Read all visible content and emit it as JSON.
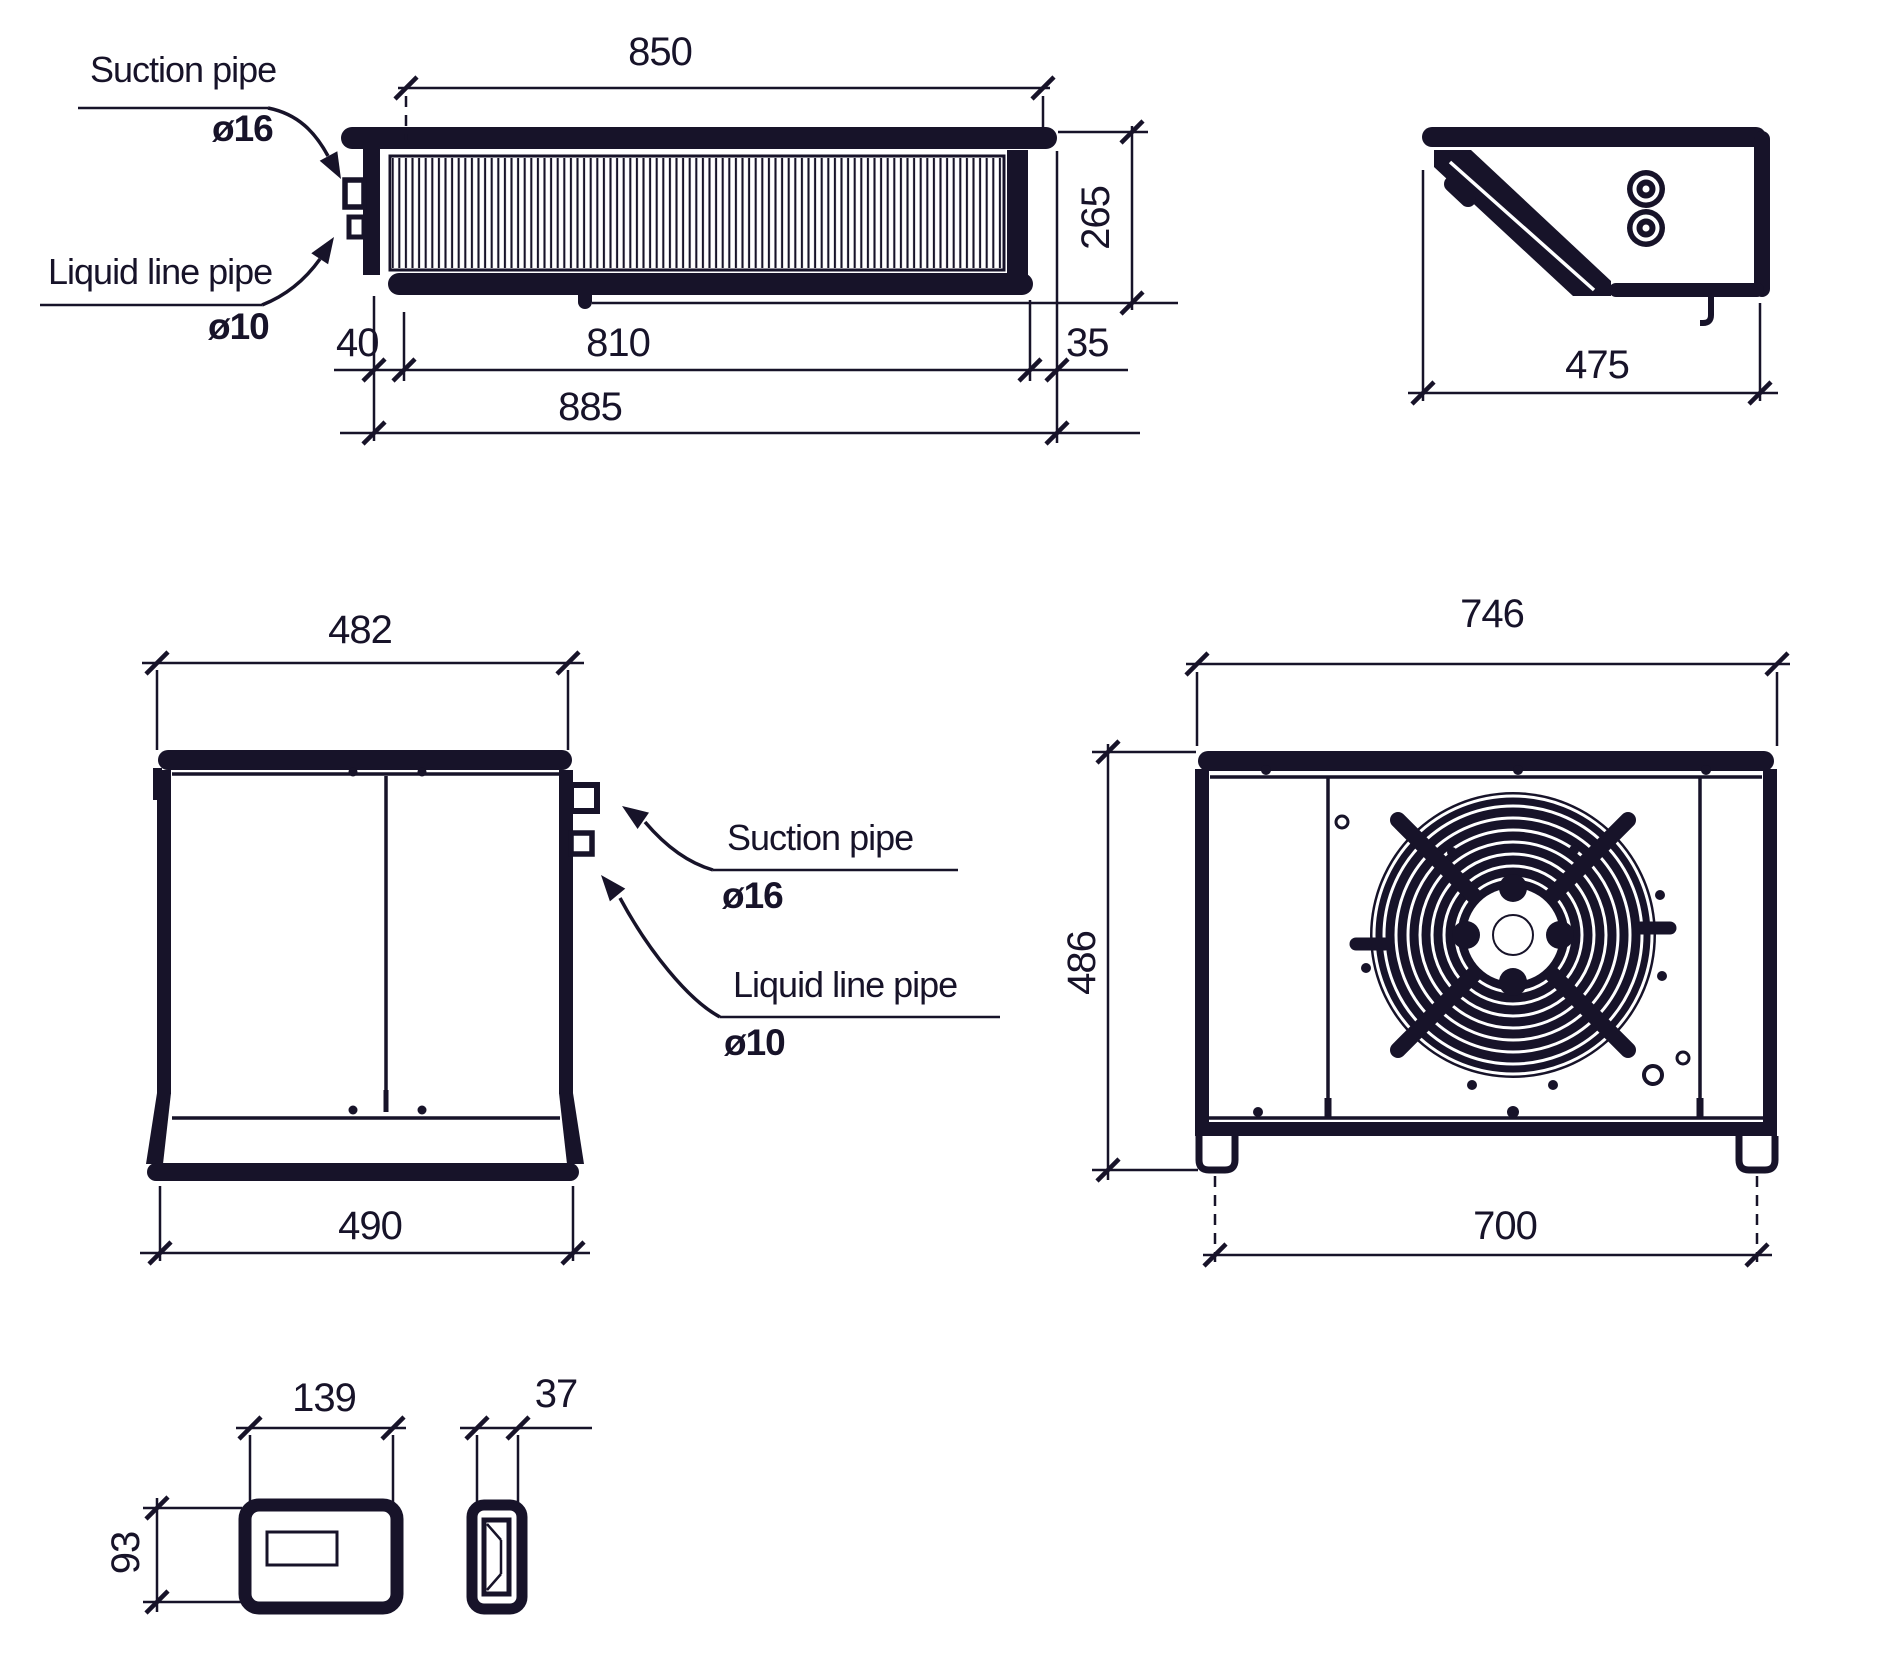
{
  "colors": {
    "ink": "#171329",
    "background": "#ffffff"
  },
  "views": {
    "evaporator_top_view": {
      "labels": {
        "suction_pipe": "Suction pipe",
        "suction_diameter": "ø16",
        "liquid_line_pipe": "Liquid line pipe",
        "liquid_diameter": "ø10"
      },
      "dimensions": {
        "overall_width_top": "850",
        "depth": "265",
        "pipe_offset": "40",
        "coil_width": "810",
        "end_offset": "35",
        "overall_width": "885"
      }
    },
    "evaporator_end_view": {
      "dimensions": {
        "depth": "475"
      }
    },
    "evaporator_side_view": {
      "labels": {
        "suction_pipe": "Suction pipe",
        "suction_diameter": "ø16",
        "liquid_line_pipe": "Liquid line pipe",
        "liquid_diameter": "ø10"
      },
      "dimensions": {
        "top_width": "482",
        "bottom_width": "490"
      }
    },
    "condensing_unit_front_view": {
      "dimensions": {
        "width": "746",
        "height": "486",
        "feet_spacing": "700"
      }
    },
    "controller_front_view": {
      "dimensions": {
        "width": "139",
        "height": "93"
      }
    },
    "controller_side_view": {
      "dimensions": {
        "width": "37"
      }
    }
  }
}
